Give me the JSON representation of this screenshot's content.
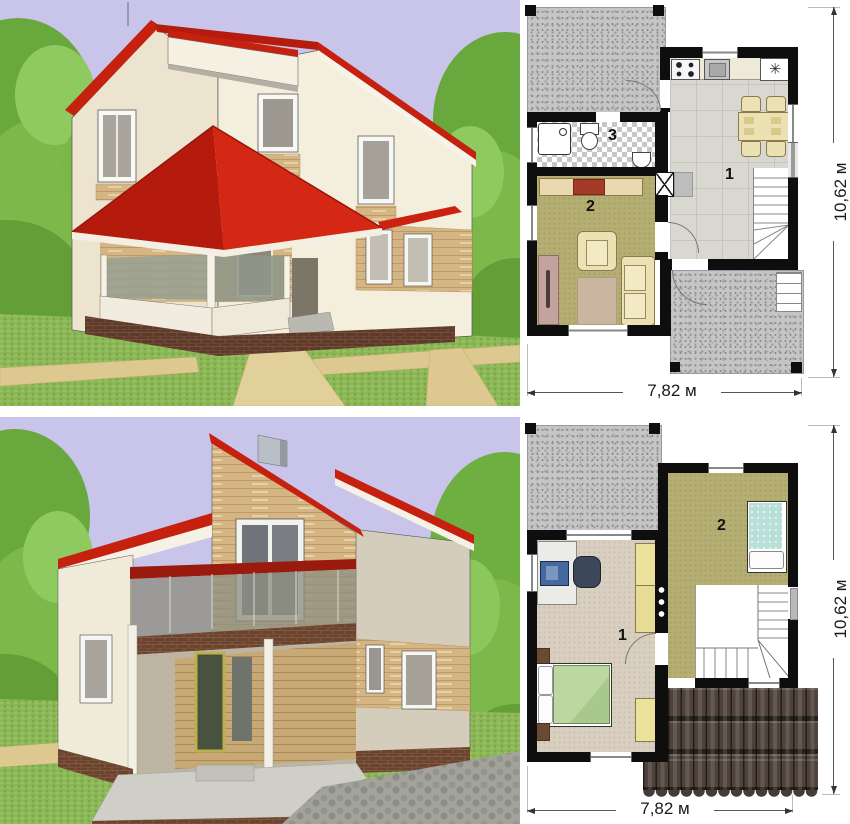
{
  "colors": {
    "sky": "#c8c4ea",
    "grass": "#8cb757",
    "foliage": "#7cb94a",
    "roof_red": "#c6200f",
    "wall_cream": "#f1ead8",
    "wood_panel": "#d6b585",
    "brick": "#6b4430",
    "sand_path": "#ddc88f",
    "plan_wall": "#0e0e0e",
    "terrace_gray": "#c5c5c5",
    "tile_floor": "#d8d8d0",
    "olive_floor": "#b4ae72",
    "beige_floor": "#d9cfc0",
    "furniture_cream": "#ece1b3",
    "bed_green": "#b5d29a",
    "bed_blue": "#b9e0d8",
    "roof_tile_brown": "#4e423a"
  },
  "plan_first": {
    "rooms": [
      {
        "id": "kitchen-dining-room",
        "number": "1"
      },
      {
        "id": "living-room",
        "number": "2"
      },
      {
        "id": "bathroom",
        "number": "3"
      }
    ],
    "width_label": "7,82 м",
    "height_label": "10,62 м",
    "freezer_symbol": "✳"
  },
  "plan_second": {
    "rooms": [
      {
        "id": "bedroom-office",
        "number": "1"
      },
      {
        "id": "bedroom",
        "number": "2"
      }
    ],
    "width_label": "7,82 м",
    "height_label": "10,62 м"
  }
}
